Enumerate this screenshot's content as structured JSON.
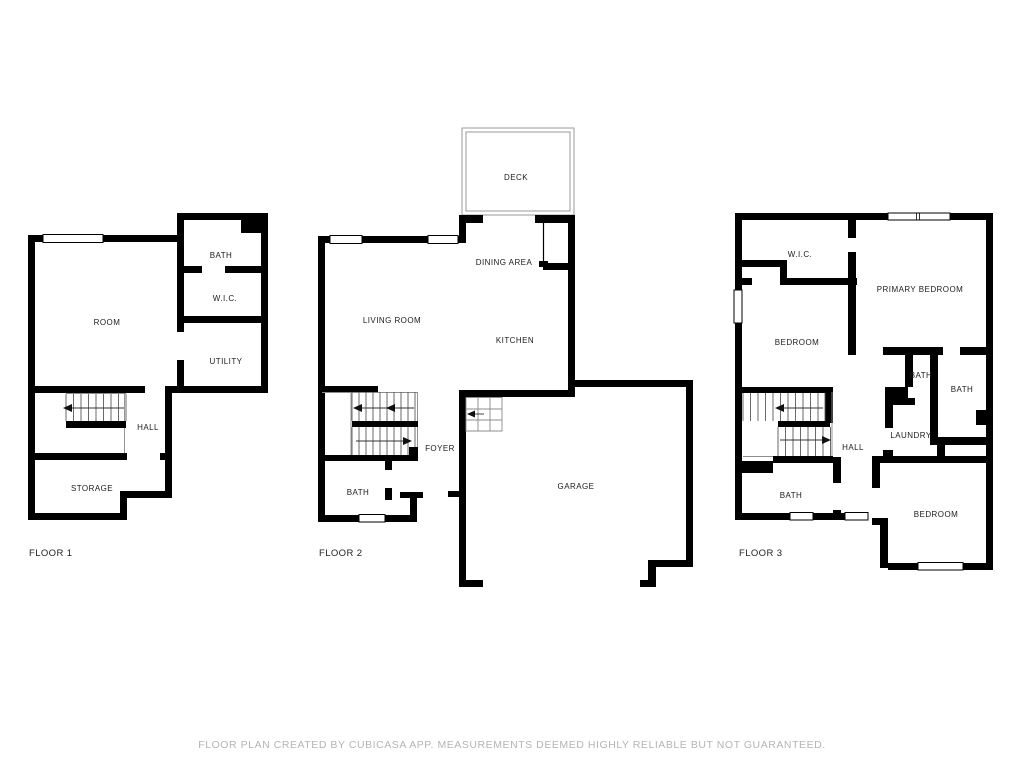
{
  "disclaimer": "FLOOR PLAN CREATED BY CUBICASA APP. MEASUREMENTS DEEMED HIGHLY RELIABLE BUT NOT GUARANTEED.",
  "floors": [
    {
      "name": "FLOOR 1",
      "rooms": [
        {
          "label": "BATH"
        },
        {
          "label": "W.I.C."
        },
        {
          "label": "ROOM"
        },
        {
          "label": "UTILITY"
        },
        {
          "label": "HALL"
        },
        {
          "label": "STORAGE"
        }
      ]
    },
    {
      "name": "FLOOR 2",
      "rooms": [
        {
          "label": "DECK"
        },
        {
          "label": "DINING AREA"
        },
        {
          "label": "LIVING ROOM"
        },
        {
          "label": "KITCHEN"
        },
        {
          "label": "FOYER"
        },
        {
          "label": "BATH"
        },
        {
          "label": "GARAGE"
        }
      ]
    },
    {
      "name": "FLOOR 3",
      "rooms": [
        {
          "label": "W.I.C."
        },
        {
          "label": "PRIMARY BEDROOM"
        },
        {
          "label": "BEDROOM"
        },
        {
          "label": "BATH"
        },
        {
          "label": "BATH"
        },
        {
          "label": "LAUNDRY"
        },
        {
          "label": "HALL"
        },
        {
          "label": "BATH"
        },
        {
          "label": "BEDROOM"
        }
      ]
    }
  ],
  "symbols": {
    "stair_arrow": "filled-triangle",
    "window": "white-rect-thin-black-border",
    "wall": "solid-black",
    "deck": "thin-double-gray-outline"
  },
  "colors": {
    "background": "#ffffff",
    "wall": "#000000",
    "room_label": "#1c1c1c",
    "floor_label": "#222222",
    "disclaimer_text": "#b4b4b4",
    "deck_outline": "#9a9a9a",
    "stair_tread": "#5a5a5a"
  }
}
